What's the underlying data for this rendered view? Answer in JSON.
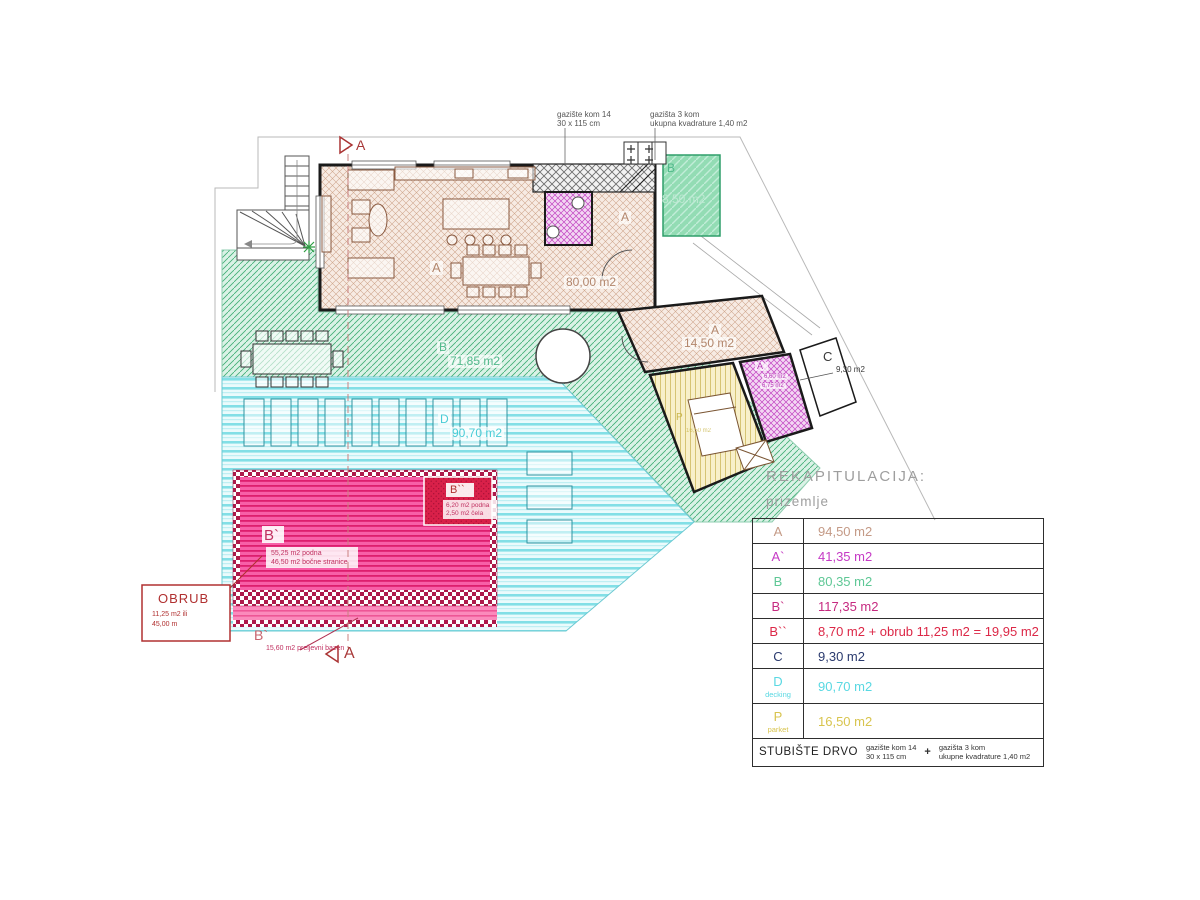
{
  "colors": {
    "tan": "#b3876d",
    "green": "#52b98c",
    "deck": "#49ccd6",
    "magenta": "#b535b5",
    "dark": "#3a3a3a",
    "pool": "#c03060",
    "poolLight": "#c8646e",
    "red": "#b03030",
    "marker": "#a83838",
    "note": "#555555",
    "gold": "#c9b64a"
  },
  "notes": {
    "left": {
      "l1": "gazište kom 14",
      "l2": "30 x 115 cm"
    },
    "right": {
      "l1": "gazišta 3 kom",
      "l2": "ukupna kvadrature 1,40 m2"
    }
  },
  "markers": {
    "section": "A"
  },
  "plan": {
    "living": {
      "zone": "A",
      "entry_zone": "A",
      "area": "80,00 m2"
    },
    "terrace": {
      "zone": "B",
      "area": "71,85 m2"
    },
    "upper_terrace": {
      "zone": "B",
      "area": "8,50 m2"
    },
    "decking": {
      "zone": "D",
      "area": "90,70 m2"
    },
    "bedroom": {
      "zone": "A",
      "area": "14,50 m2"
    },
    "bath": {
      "zone": "A`",
      "l1": "6,60 m2",
      "l2": "6,75 m2"
    },
    "parquet": {
      "zone": "P",
      "area": "16,50 m2"
    },
    "terrace_c": {
      "zone": "C",
      "area": "9,30 m2"
    },
    "pool": {
      "zone": "B`",
      "l1": "55,25 m2 podna",
      "l2": "46,50 m2 bočne stranice"
    },
    "pool_head": {
      "zone": "B``",
      "l1": "6,20 m2 podna",
      "l2": "2,50 m2 čela"
    },
    "overflow": {
      "zone": "B`",
      "note": "15,60 m2 preljevni bazen"
    },
    "obrub": {
      "title": "OBRUB",
      "l1": "11,25 m2 ili",
      "l2": "45,00 m"
    }
  },
  "legend": {
    "title": "REKAPITULACIJA:",
    "subtitle": "prizemlje",
    "rows": [
      {
        "label": "A",
        "sub": "",
        "value": "94,50 m2",
        "color": "#c49a86"
      },
      {
        "label": "A`",
        "sub": "",
        "value": "41,35 m2",
        "color": "#c53ac5"
      },
      {
        "label": "B",
        "sub": "",
        "value": "80,35 m2",
        "color": "#5ec795"
      },
      {
        "label": "B`",
        "sub": "",
        "value": "117,35 m2",
        "color": "#c62a80"
      },
      {
        "label": "B``",
        "sub": "",
        "value": "8,70 m2 + obrub 11,25 m2 = 19,95 m2",
        "color": "#dc2847"
      },
      {
        "label": "C",
        "sub": "",
        "value": "9,30 m2",
        "color": "#2a3a6e"
      },
      {
        "label": "D",
        "sub": "decking",
        "value": "90,70 m2",
        "color": "#59d8e2"
      },
      {
        "label": "P",
        "sub": "parket",
        "value": "16,50 m2",
        "color": "#d8c44e"
      }
    ],
    "footer": {
      "label": "STUBIŠTE DRVO",
      "left1": "gazište kom 14",
      "left2": "30 x 115 cm",
      "plus": "+",
      "right1": "gazišta 3 kom",
      "right2": "ukupne kvadrature 1,40 m2"
    }
  }
}
